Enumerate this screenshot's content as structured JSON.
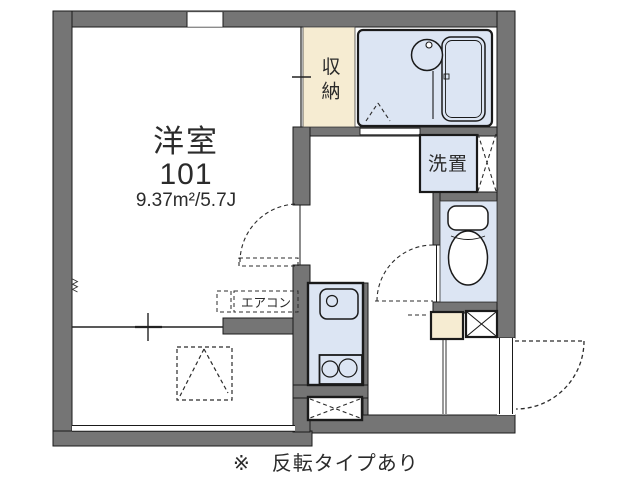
{
  "floor_plan": {
    "room": {
      "label": "洋室",
      "number": "101",
      "area": "9.37m²/5.7J"
    },
    "closet_label": "収納",
    "washer_label": "洗置",
    "aircon_label": "エアコン",
    "footnote": "※　反転タイプあり",
    "colors": {
      "wall_gray": "#757575",
      "wet_area_blue": "#dce5f3",
      "closet_cream": "#f6ecd2",
      "outline_black": "#1a1a1a",
      "floor_white": "#ffffff"
    }
  }
}
